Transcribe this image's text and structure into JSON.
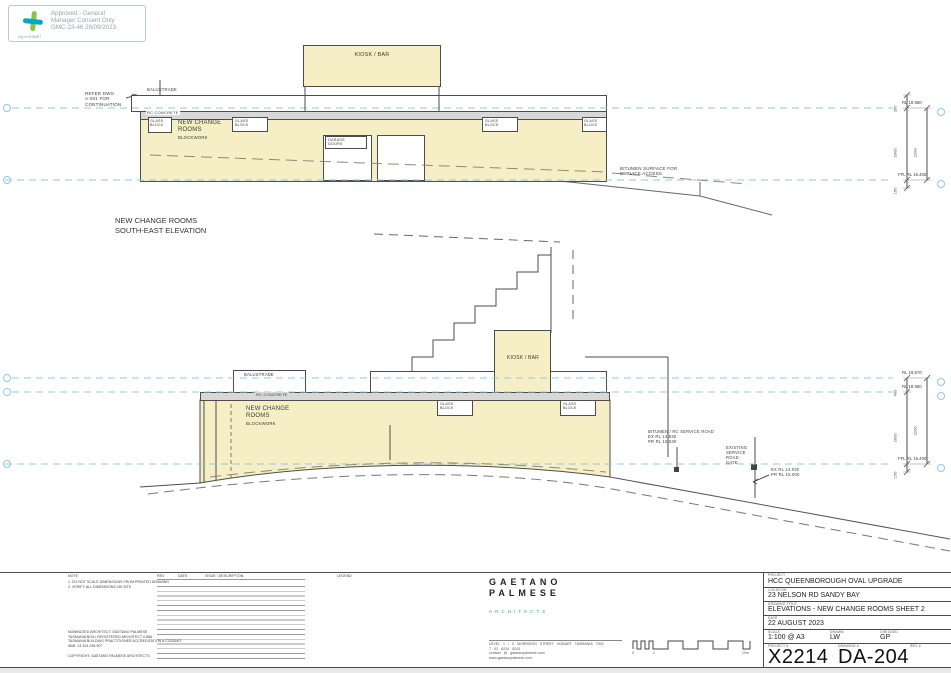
{
  "colors": {
    "building_fill": "#f6efc5",
    "concrete_fill": "#d8d8d8",
    "level_line": "#8fc8e0",
    "accent_teal": "#2ea3b5",
    "stamp_green": "#8bc53f",
    "stamp_blue": "#00a6ce"
  },
  "stamp": {
    "line1": "Approved - General",
    "line2": "Manager Consent Only",
    "line3": "GMC-23-46 28/09/2023",
    "logo_caption": "City of HOBART"
  },
  "labels": {
    "kiosk": "KIOSK / BAR",
    "balustrade": "BALUSTRADE",
    "rc_concrete": "RC CONCRETE",
    "rooms_l1": "NEW CHANGE",
    "rooms_l2": "ROOMS",
    "rooms_l3": "BLOCKWORK",
    "glass_l1": "GLASS",
    "glass_l2": "BLOCK",
    "garage_l1": "GARAGE",
    "garage_l2": "DOORS"
  },
  "elevation1": {
    "title_l1": "NEW CHANGE ROOMS",
    "title_l2": "SOUTH-EAST ELEVATION",
    "refer_l1": "REFER  DWG",
    "refer_l2": "A-201 FOR",
    "refer_l3": "CONTINUATION",
    "bitumen_l1": "BITUMEN SURFACE FOR",
    "bitumen_l2": "SERVICE ACCESS",
    "rl_top": "RL 18.950",
    "rl_ffl": "FFL RL 16.400",
    "dim_a": "350",
    "dim_b": "2000",
    "dim_c": "2200",
    "dim_d": "150"
  },
  "elevation2": {
    "road_l1": "BITUMEN / RC SERVICE ROAD",
    "road_l2": "EX RL 14.530",
    "road_l3": "PR RL 15.530",
    "gate_l1": "EXISTING",
    "gate_l2": "SERVICE",
    "gate_l3": "ROAD",
    "gate_l4": "GATE",
    "rl2_l1": "EX RL 14.030",
    "rl2_l2": "PR RL 15.000",
    "rl_top": "RL 19.570",
    "rl_mid": "RL 18.950",
    "rl_ffl": "FFL RL 16.400",
    "dim_a": "400",
    "dim_b": "2000",
    "dim_c": "2200",
    "dim_d": "150"
  },
  "titleblock": {
    "note_header": "NOTE",
    "note1": "1. DO NOT SCALE DIMENSIONS FROM PRINTED DRAWING",
    "note2": "2. VERIFY ALL DIMENSIONS ON SITE",
    "arch1": "NOMINATED ARCHITECT: GAETANO PALMESE",
    "arch2": "TASMANIA BOA / REGISTERED ARCHITECT # 886",
    "arch3": "TASMANIA BUILDING PRACTITIONER ACCREDITATION # CC6164O",
    "arch4": "ABN: 24 324 038 907",
    "copyright": "COPYRIGHT: GAETANO PALMESE ARCHITECTS",
    "rev_header": "REV",
    "date_header": "DATE",
    "issue_header": "ISSUE / DESCRIPTION",
    "legend_header": "LEGEND",
    "firm_l1": "GAETANO",
    "firm_l2": "PALMESE",
    "firm_sub": "ARCHITECTS",
    "addr1": "LEVEL 1 / 5 MORRISON STREET   HOBART   TASMANIA   7000",
    "addr2": "T   03 6234 5243",
    "addr3": "contact @ gaetanopalmese.com",
    "addr4": "www.gaetanopalmese.com",
    "scalebar_0": "0",
    "scalebar_1": "1",
    "scalebar_end": "10m",
    "project_label": "PROJECT",
    "project": "HCC QUEENBOROUGH OVAL UPGRADE",
    "location_label": "LOCATION",
    "location": "23 NELSON RD SANDY BAY",
    "drawing_label": "DRAWING TITLE",
    "drawing": "ELEVATIONS - NEW CHANGE ROOMS SHEET 2",
    "date_label": "DATE",
    "date": "22 AUGUST 2023",
    "scale_label": "SCALE",
    "scale": "1:100 @ A3",
    "drawn_label": "DRAWN",
    "drawn": "LW",
    "checked_label": "CHECKED",
    "checked": "GP",
    "projectno_label": "PROJECT #",
    "projectno": "X2214",
    "drawingno_label": "DRAWING #",
    "drawingno": "DA-204",
    "revno_label": "REV #"
  }
}
